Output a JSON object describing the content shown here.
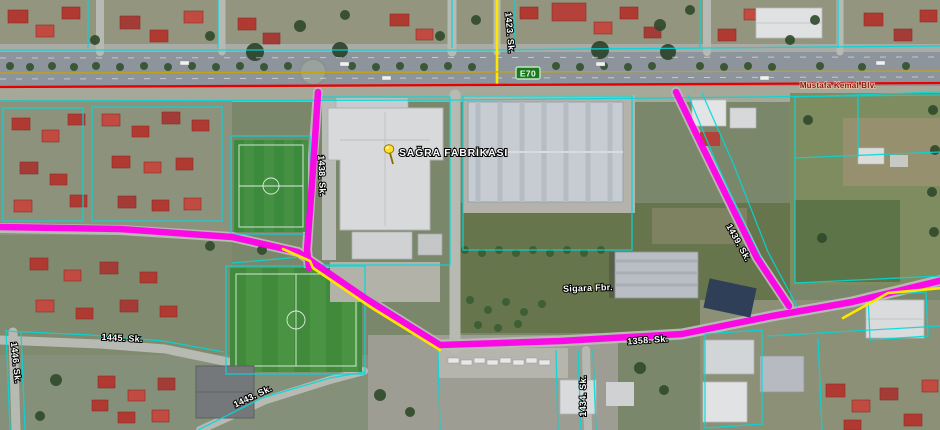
{
  "map": {
    "places": {
      "sagra": "SAĞRA FABRİKASI",
      "sigara": "Sigara Fbr."
    },
    "shield": {
      "label": "E70"
    },
    "roads": {
      "mustafa_kemal": "Mustafa Kemal Blv.",
      "sk1423": "1423. Sk.",
      "sk1434": "1434. Sk.",
      "sk1438": "1438. Sk.",
      "sk1439": "1439. Sk.",
      "sk1443": "1443. Sk.",
      "sk1445": "1445. Sk.",
      "sk1446": "1446. Sk.",
      "sk1358": "1358. Sk."
    },
    "colors": {
      "route_highlight": "#ff00e8",
      "parcel_line": "#00d9d9",
      "highway_line": "#e80000",
      "secondary_route": "#ffe600",
      "shield_bg": "#1c7a1c",
      "pin": "#ffd700"
    }
  }
}
